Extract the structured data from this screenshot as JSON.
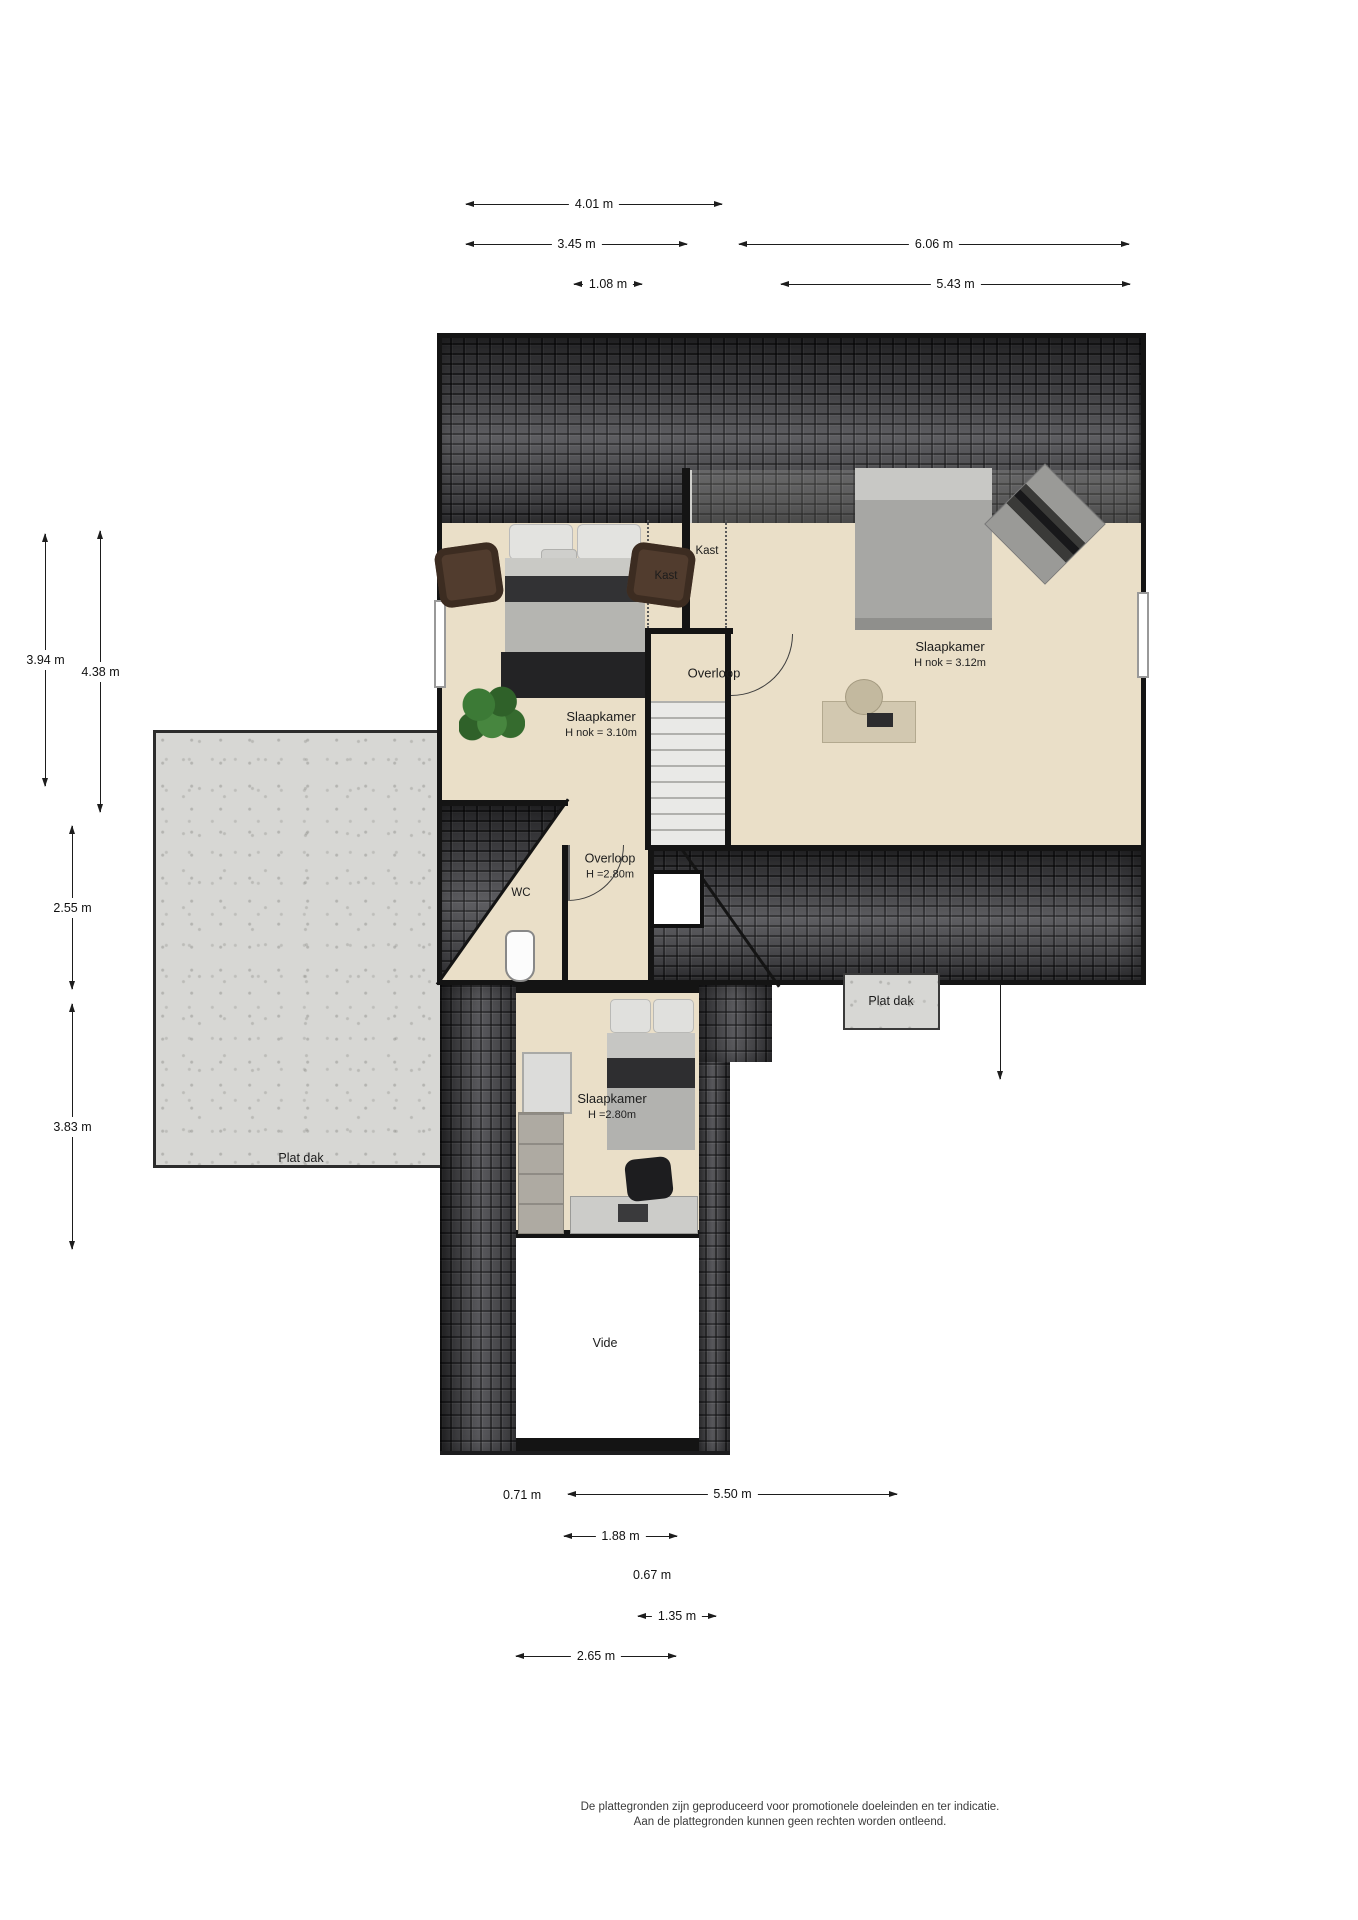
{
  "rooms": {
    "bedroom_left": {
      "name": "Slaapkamer",
      "sub": "H nok = 3.10m"
    },
    "bedroom_right": {
      "name": "Slaapkamer",
      "sub": "H nok = 3.12m"
    },
    "bedroom_lower": {
      "name": "Slaapkamer",
      "sub": "H =2.80m"
    },
    "landing_upper": {
      "name": "Overloop"
    },
    "landing_mid": {
      "name": "Overloop",
      "sub": "H =2.80m"
    },
    "wc": {
      "name": "WC"
    },
    "closet_left": {
      "name": "Kast"
    },
    "closet_right": {
      "name": "Kast"
    },
    "vide": {
      "name": "Vide"
    },
    "flat_roof_left": {
      "name": "Plat dak"
    },
    "flat_roof_small": {
      "name": "Plat dak"
    }
  },
  "dims": {
    "top": [
      "4.01 m",
      "3.45 m",
      "6.06 m",
      "1.08 m",
      "5.43 m"
    ],
    "left": [
      "3.94 m",
      "4.38 m",
      "2.55 m",
      "3.83 m"
    ],
    "right": [
      "2.35 m",
      "2.25 m",
      "1.60 m",
      "4.70 m",
      "3.94 m",
      "5.10 m"
    ],
    "bottom": [
      "0.71 m",
      "5.50 m",
      "1.88 m",
      "0.67 m",
      "1.35 m",
      "2.65 m"
    ]
  },
  "footer": {
    "line1": "De plattegronden zijn geproduceerd voor promotionele doeleinden en ter indicatie.",
    "line2": "Aan de plattegronden kunnen geen rechten worden ontleend."
  },
  "colors": {
    "floor": "#eadfc8",
    "roof": "#4b4b4f",
    "concrete": "#d7d7d4",
    "wall": "#141414"
  }
}
